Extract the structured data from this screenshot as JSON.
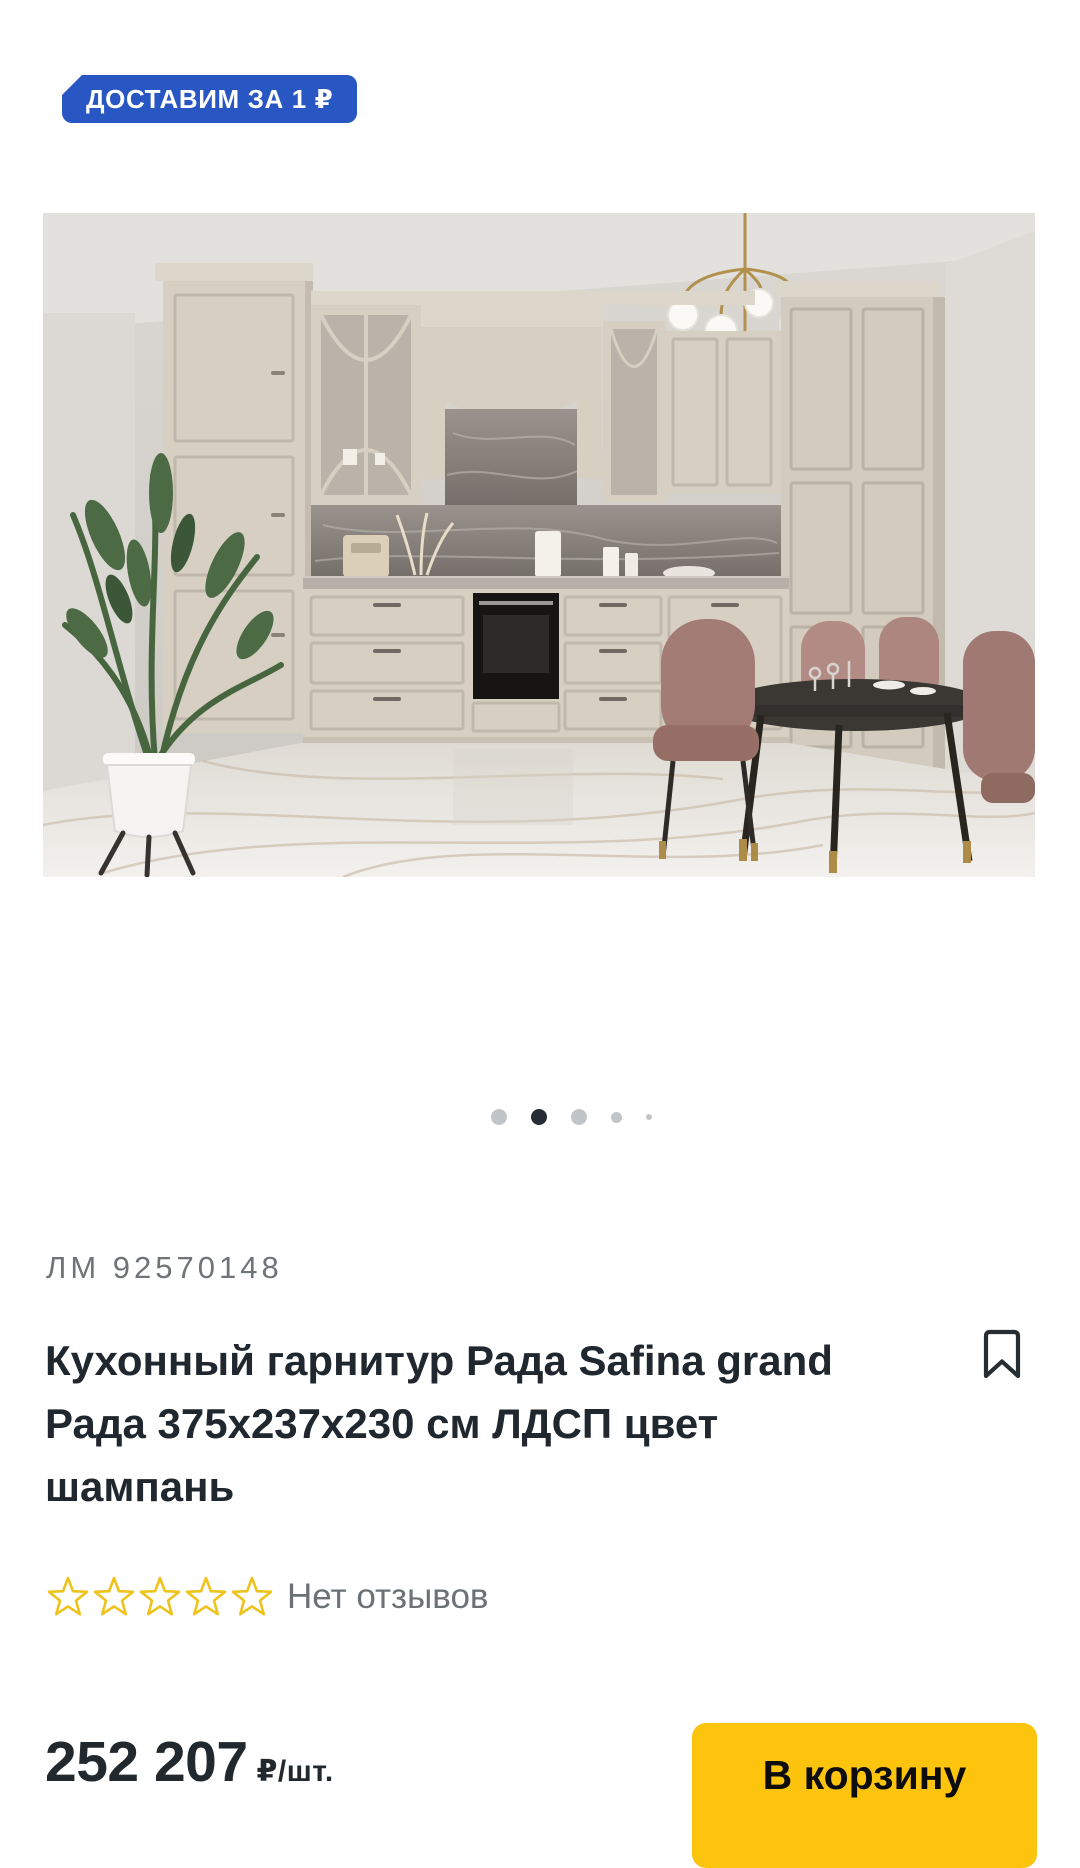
{
  "badge": {
    "label": "ДОСТАВИМ ЗА 1 ₽",
    "background_color": "#2857c3",
    "text_color": "#ffffff"
  },
  "gallery": {
    "dots_total": 5,
    "active_dot_index": 2,
    "dot_active_color": "#262c33",
    "dot_inactive_color": "#c2c5c7",
    "image_description": "kitchen set in champagne color with marble floor, dining table and chairs"
  },
  "product": {
    "sku": "ЛМ 92570148",
    "title_lines": [
      "Кухонный гарнитур Рада Safina grand",
      "Рада 375х237х230 см ЛДСП цвет",
      "шампань"
    ],
    "rating": {
      "stars_total": 5,
      "stars_filled": 0,
      "star_color": "#edc31c",
      "reviews_label": "Нет отзывов"
    },
    "price": {
      "amount": "252 207",
      "unit": "₽/шт."
    },
    "cart_button": {
      "label": "В корзину",
      "background_color": "#fdc40d"
    }
  },
  "icons": {
    "bookmark_icon_color": "#262d33"
  }
}
